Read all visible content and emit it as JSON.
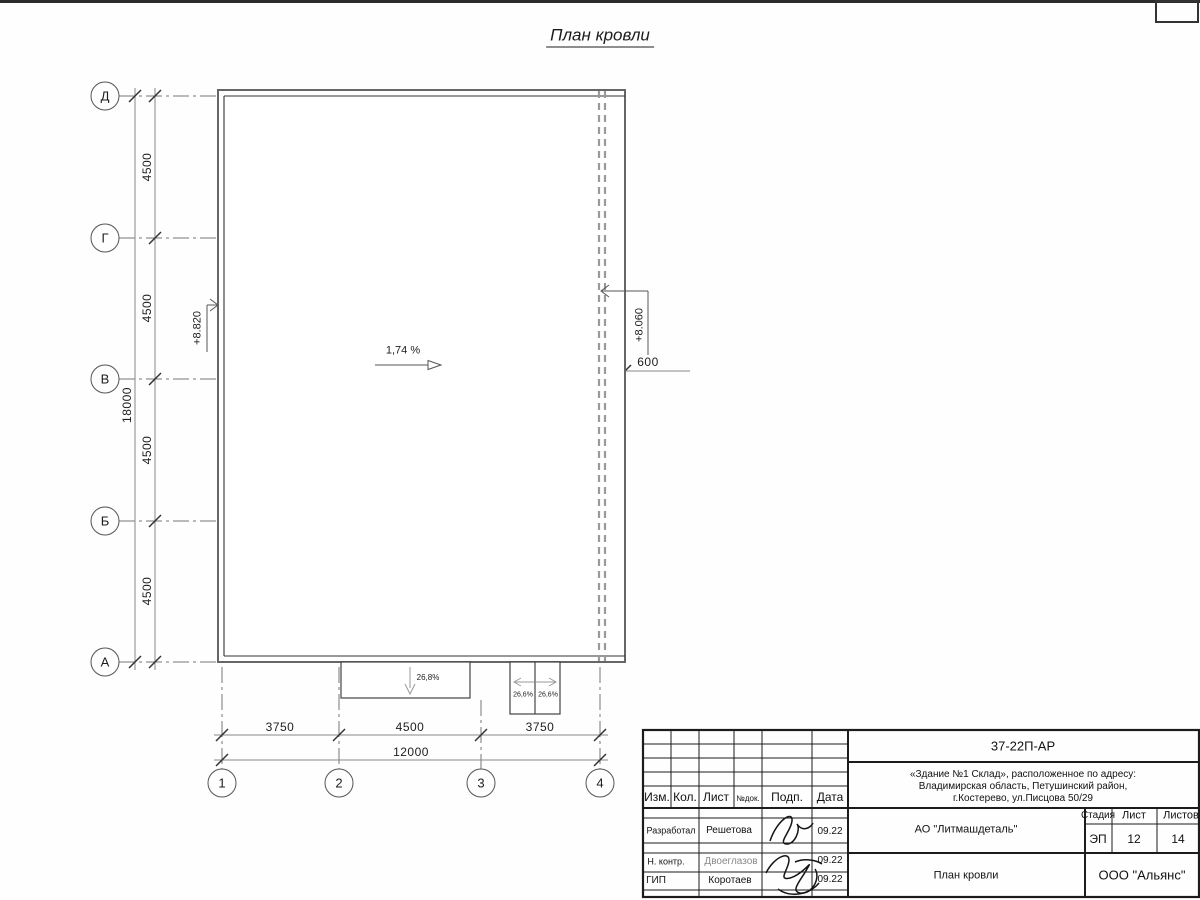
{
  "sheet": {
    "title": "План кровли"
  },
  "plan": {
    "row_axes": [
      "Д",
      "Г",
      "В",
      "Б",
      "А"
    ],
    "col_axes": [
      "1",
      "2",
      "3",
      "4"
    ],
    "row_dims": [
      "4500",
      "4500",
      "4500",
      "4500"
    ],
    "row_dim_total": "18000",
    "col_dims": [
      "3750",
      "4500",
      "3750"
    ],
    "col_dim_total": "12000",
    "gutter_dim": "600",
    "elevation_high": "+8.820",
    "elevation_low": "+8.060",
    "main_slope": "1,74 %",
    "canopy_slope": "26,8%",
    "porch_slope_left": "26,6%",
    "porch_slope_right": "26,6%"
  },
  "titleblock": {
    "doc_code": "37-22П-АР",
    "address_line1": "«Здание №1 Склад», расположенное по адресу:",
    "address_line2": "Владимирская область, Петушинский район,",
    "address_line3": "г.Костерево, ул.Писцова 50/29",
    "header": {
      "izm": "Изм.",
      "kol": "Кол.",
      "list": "Лист",
      "ndok": "№док.",
      "podp": "Подп.",
      "data": "Дата"
    },
    "rows": [
      {
        "role": "Разработал",
        "name": "Решетова",
        "date": "09.22"
      },
      {
        "role": "Н. контр.",
        "name": "Двоеглазов",
        "date": "09.22"
      },
      {
        "role": "ГИП",
        "name": "Коротаев",
        "date": "09.22"
      }
    ],
    "client": "АО \"Литмашдеталь\"",
    "stage_label": "Стадия",
    "sheet_label": "Лист",
    "sheets_label": "Листов",
    "stage": "ЭП",
    "sheet_num": "12",
    "sheets_total": "14",
    "doc_title": "План кровли",
    "company": "ООО \"Альянс\""
  }
}
